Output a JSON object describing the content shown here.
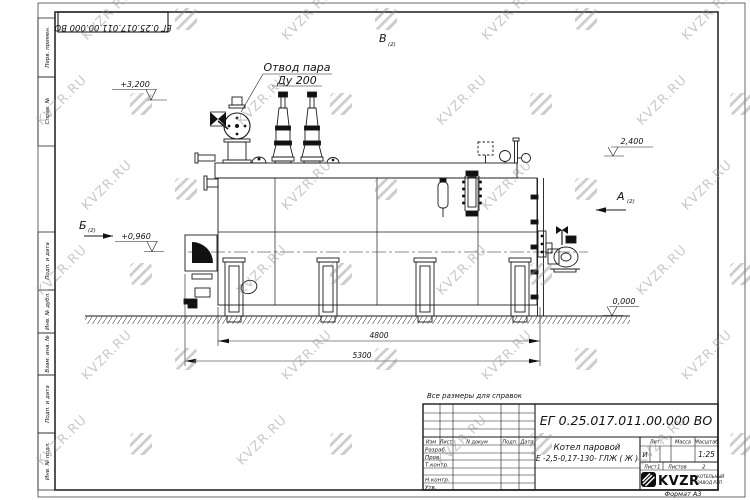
{
  "watermark": {
    "text": "KVZR.RU"
  },
  "frame": {
    "top_stamp_number": "ЕГ 0.25.017.011.00.000  ВО",
    "format_note": "Формат А3",
    "margin_columns": [
      "Перв. примен.",
      "Справ. №",
      "Подп. и дата",
      "Инв. № дубл.",
      "Взам. инв. №",
      "Подп. и дата",
      "Инв. № подл."
    ]
  },
  "drawing": {
    "note": "Все размеры для справок",
    "steam_outlet": {
      "line1": "Отвод пара",
      "line2": "Ду 200"
    },
    "views": {
      "top": {
        "label": "В",
        "ref": "(2)"
      },
      "right": {
        "label": "А",
        "ref": "(2)"
      },
      "left": {
        "label": "Б",
        "ref": "(2)"
      }
    },
    "elevations": {
      "top_left": "+3,200",
      "mid_left": "+0,960",
      "right_upper": "2,400",
      "right_zero": "0,000"
    },
    "dimensions": {
      "inner": "4800",
      "overall": "5300"
    }
  },
  "title_block": {
    "doc_number": "ЕГ 0.25.017.011.00.000  ВО",
    "product_name": "Котел паровой",
    "product_code": "Е -2,5-0,17-130- ГЛЖ ( Ж )",
    "columns": {
      "izm": "Изм",
      "list": "Лист",
      "n_doc": "N докум",
      "podp": "Подп.",
      "data": "Дата"
    },
    "rows": {
      "razrab": "Разраб.",
      "prov": "Пров.",
      "t_contr": "Т.контр.",
      "n_contr": "Н.контр.",
      "utv": "Утв."
    },
    "lit": {
      "label": "Лит.",
      "value": "И"
    },
    "massa": {
      "label": "Масса"
    },
    "scale": {
      "label": "Масштаб",
      "value": "1:25"
    },
    "sheet": {
      "label": "Лист",
      "value": "1"
    },
    "sheets": {
      "label": "Листов",
      "value": "2"
    },
    "company": {
      "logo": "KVZR",
      "sub1": "КОТЕЛЬНЫЙ",
      "sub2": "ЗАВОД РЭП"
    }
  }
}
